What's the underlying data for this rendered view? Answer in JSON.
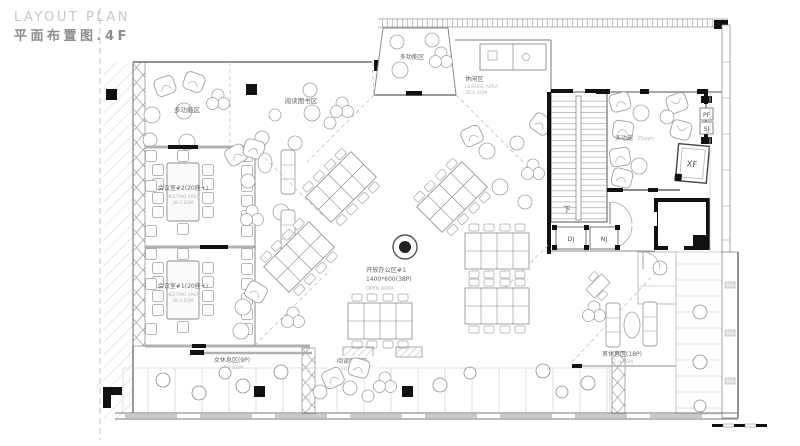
{
  "title": {
    "en": "LAYOUT PLAN",
    "cn": "平面布置图.4F"
  },
  "rooms": {
    "multi_top_left": {
      "name": "多功能区"
    },
    "reading_top": {
      "name": "阅读图书区"
    },
    "multi_top_center": {
      "name": "多功能区"
    },
    "leisure": {
      "name": "休闲区",
      "sub": "LEISURE AREA",
      "area": "38.0 SQM"
    },
    "meeting2": {
      "name": "会议室#2(20座+)",
      "sub": "MEETING AREA",
      "area": "38.0 SQM"
    },
    "meeting1": {
      "name": "会议室#1(20座+)",
      "sub": "MEETING AREA",
      "area": "38.0 SQM"
    },
    "open_office": {
      "name": "开放办公区#1",
      "spec": "1400*600(38P)",
      "sub": "OPEN AREA"
    },
    "multi_right": {
      "name": "多功能",
      "area": "25sqm"
    },
    "stair_down": {
      "name": "下"
    },
    "women_rest": {
      "name": "女休息区(9P)",
      "area": "35.0 SQM"
    },
    "men_rest": {
      "name": "男休息区(18P)",
      "area": "57.0 SQM"
    },
    "reading_bottom": {
      "name": "阅读图书区",
      "area": "40.0 SQM"
    }
  },
  "shafts": {
    "dj": "DJ",
    "nj": "NJ",
    "pf": "PF",
    "sj": "SJ",
    "xf": "XF"
  },
  "colors": {
    "wall": "#555555",
    "black": "#111111",
    "hatch": "#cccccc",
    "label": "#666666",
    "sublabel": "#b8b8b8"
  }
}
